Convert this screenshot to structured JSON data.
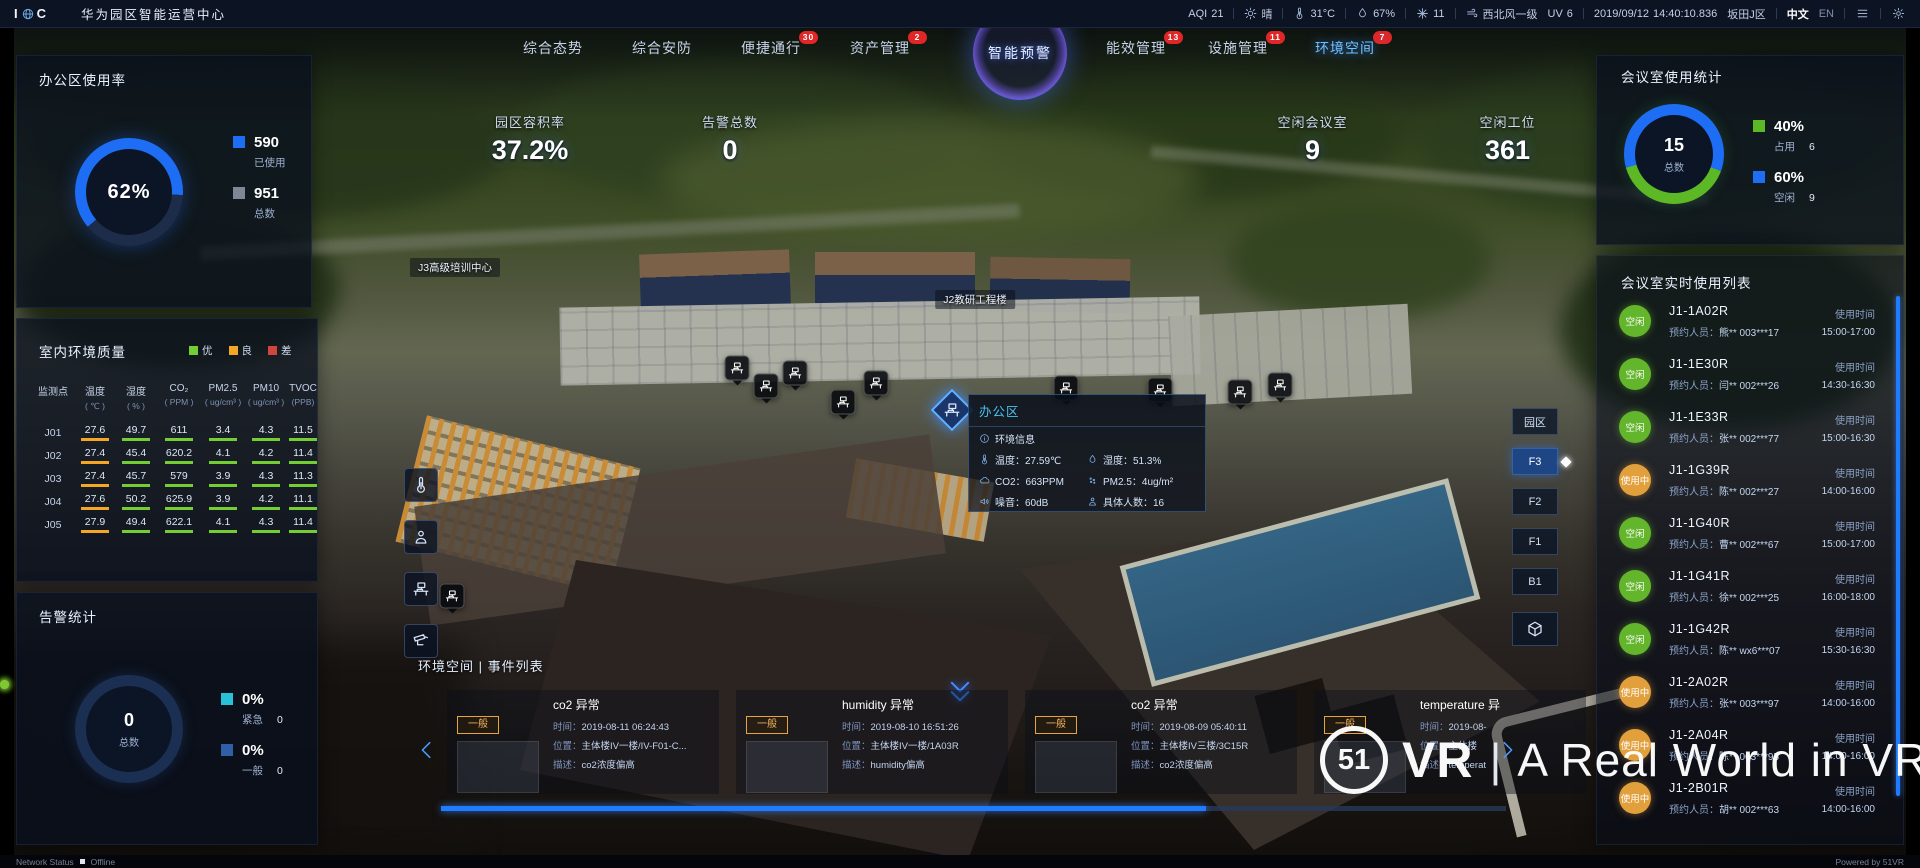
{
  "topbar": {
    "logo_left": "I",
    "logo_right": "C",
    "title": "华为园区智能运营中心",
    "aqi": {
      "label": "AQI",
      "value": "21"
    },
    "weather_text": "晴",
    "temperature": "31°C",
    "humidity": "67%",
    "pm_value": "11",
    "wind": "西北风一级",
    "uv": {
      "label": "UV",
      "value": "6"
    },
    "date": "2019/09/12",
    "time": "14:40:10.836",
    "district": "坂田J区",
    "lang": {
      "zh": "中文",
      "en": "EN"
    }
  },
  "nav": {
    "left_tabs": [
      {
        "label": "综合态势"
      },
      {
        "label": "综合安防"
      },
      {
        "label": "便捷通行",
        "badge": "30"
      },
      {
        "label": "资产管理",
        "badge": "2"
      }
    ],
    "right_tabs": [
      {
        "label": "能效管理",
        "badge": "13"
      },
      {
        "label": "设施管理",
        "badge": "11"
      },
      {
        "label": "环境空间",
        "badge": "7",
        "active": true
      }
    ],
    "center_label": "智能预警"
  },
  "kpis": {
    "left": [
      {
        "label": "园区容积率",
        "value": "37.2%"
      },
      {
        "label": "告警总数",
        "value": "0"
      }
    ],
    "right": [
      {
        "label": "空闲会议室",
        "value": "9"
      },
      {
        "label": "空闲工位",
        "value": "361"
      }
    ]
  },
  "office_usage": {
    "title": "办公区使用率",
    "percent": "62%",
    "legend": [
      {
        "value": "590",
        "label": "已使用",
        "color": "#1e6ef5"
      },
      {
        "value": "951",
        "label": "总数",
        "color": "#7d8798"
      }
    ]
  },
  "env_quality": {
    "title": "室内环境质量",
    "legend": [
      {
        "label": "优",
        "color": "#74ce33"
      },
      {
        "label": "良",
        "color": "#f5a623"
      },
      {
        "label": "差",
        "color": "#d0453e"
      }
    ],
    "columns": [
      [
        "监测点",
        ""
      ],
      [
        "温度",
        "( ℃ )"
      ],
      [
        "湿度",
        "( % )"
      ],
      [
        "CO₂",
        "( PPM )"
      ],
      [
        "PM2.5",
        "( ug/cm³ )"
      ],
      [
        "PM10",
        "( ug/cm³ )"
      ],
      [
        "TVOC",
        "(PPB)"
      ]
    ],
    "rows": [
      {
        "id": "J01",
        "values": [
          [
            "27.6",
            "o"
          ],
          [
            "49.7",
            "g"
          ],
          [
            "611",
            "g"
          ],
          [
            "3.4",
            "g"
          ],
          [
            "4.3",
            "g"
          ],
          [
            "11.5",
            "g"
          ]
        ]
      },
      {
        "id": "J02",
        "values": [
          [
            "27.4",
            "o"
          ],
          [
            "45.4",
            "g"
          ],
          [
            "620.2",
            "g"
          ],
          [
            "4.1",
            "g"
          ],
          [
            "4.2",
            "g"
          ],
          [
            "11.4",
            "g"
          ]
        ]
      },
      {
        "id": "J03",
        "values": [
          [
            "27.4",
            "o"
          ],
          [
            "45.7",
            "g"
          ],
          [
            "579",
            "g"
          ],
          [
            "3.9",
            "g"
          ],
          [
            "4.3",
            "g"
          ],
          [
            "11.3",
            "g"
          ]
        ]
      },
      {
        "id": "J04",
        "values": [
          [
            "27.6",
            "o"
          ],
          [
            "50.2",
            "g"
          ],
          [
            "625.9",
            "g"
          ],
          [
            "3.9",
            "g"
          ],
          [
            "4.2",
            "g"
          ],
          [
            "11.1",
            "g"
          ]
        ]
      },
      {
        "id": "J05",
        "values": [
          [
            "27.9",
            "o"
          ],
          [
            "49.4",
            "g"
          ],
          [
            "622.1",
            "g"
          ],
          [
            "4.1",
            "g"
          ],
          [
            "4.3",
            "g"
          ],
          [
            "11.4",
            "g"
          ]
        ]
      }
    ]
  },
  "alarm_stats": {
    "title": "告警统计",
    "total": "0",
    "total_label": "总数",
    "legend": [
      {
        "percent": "0%",
        "label": "紧急",
        "count": "0",
        "color": "#29c1d8"
      },
      {
        "percent": "0%",
        "label": "一般",
        "count": "0",
        "color": "#2e5fa8"
      }
    ]
  },
  "meeting_stats": {
    "title": "会议室使用统计",
    "total": "15",
    "total_label": "总数",
    "legend": [
      {
        "percent": "40%",
        "label": "占用",
        "count": "6",
        "color": "#5cb824"
      },
      {
        "percent": "60%",
        "label": "空闲",
        "count": "9",
        "color": "#1e6ef5"
      }
    ]
  },
  "meeting_list": {
    "title": "会议室实时使用列表",
    "person_label": "预约人员：",
    "time_label": "使用时间",
    "rows": [
      {
        "room": "J1-1A02R",
        "status": "空闲",
        "status_type": "free",
        "person": "熊** 003***17",
        "time": "15:00-17:00"
      },
      {
        "room": "J1-1E30R",
        "status": "空闲",
        "status_type": "free",
        "person": "闫** 002***26",
        "time": "14:30-16:30"
      },
      {
        "room": "J1-1E33R",
        "status": "空闲",
        "status_type": "free",
        "person": "张** 002***77",
        "time": "15:00-16:30"
      },
      {
        "room": "J1-1G39R",
        "status": "使用中",
        "status_type": "busy",
        "person": "陈** 002***27",
        "time": "14:00-16:00"
      },
      {
        "room": "J1-1G40R",
        "status": "空闲",
        "status_type": "free",
        "person": "曹** 002***67",
        "time": "15:00-17:00"
      },
      {
        "room": "J1-1G41R",
        "status": "空闲",
        "status_type": "free",
        "person": "徐** 002***25",
        "time": "16:00-18:00"
      },
      {
        "room": "J1-1G42R",
        "status": "空闲",
        "status_type": "free",
        "person": "陈** wx6***07",
        "time": "15:30-16:30"
      },
      {
        "room": "J1-2A02R",
        "status": "使用中",
        "status_type": "busy",
        "person": "张** 003***97",
        "time": "14:00-16:00"
      },
      {
        "room": "J1-2A04R",
        "status": "使用中",
        "status_type": "busy",
        "person": "陈** 003***95",
        "time": "14:00-16:00"
      },
      {
        "room": "J1-2B01R",
        "status": "使用中",
        "status_type": "busy",
        "person": "胡** 002***63",
        "time": "14:00-16:00"
      }
    ]
  },
  "events": {
    "title": "环境空间 | 事件列表",
    "time_label": "时间：",
    "loc_label": "位置：",
    "desc_label": "描述：",
    "cards": [
      {
        "level": "一般",
        "title": "co2 异常",
        "time": "2019-08-11 06:24:43",
        "loc": "主体楼IV一楼/IV-F01-C...",
        "desc": "co2浓度偏高"
      },
      {
        "level": "一般",
        "title": "humidity 异常",
        "time": "2019-08-10 16:51:26",
        "loc": "主体楼IV一楼/1A03R",
        "desc": "humidity偏高"
      },
      {
        "level": "一般",
        "title": "co2 异常",
        "time": "2019-08-09 05:40:11",
        "loc": "主体楼IV三楼/3C15R",
        "desc": "co2浓度偏高"
      },
      {
        "level": "一般",
        "title": "temperature 异",
        "time": "2019-08-",
        "loc": "主体楼",
        "desc": "temperat"
      }
    ]
  },
  "tooltip": {
    "title": "办公区",
    "rows": [
      {
        "ia": "info",
        "a": "环境信息",
        "ib": "",
        "b": ""
      },
      {
        "ia": "thermometer",
        "a": "温度：27.59℃",
        "ib": "drop",
        "b": "湿度：51.3%"
      },
      {
        "ia": "co2",
        "a": "CO2：663PPM",
        "ib": "pm",
        "b": "PM2.5：4ug/m²"
      },
      {
        "ia": "noise",
        "a": "噪音：60dB",
        "ib": "meeting-person",
        "b": "具体人数：16"
      }
    ]
  },
  "floors": {
    "items": [
      "园区",
      "F3",
      "F2",
      "F1",
      "B1"
    ],
    "active": "F3"
  },
  "toolbar": {
    "buttons": [
      "thermometer",
      "meeting-person",
      "workstation",
      "camera"
    ]
  },
  "scene": {
    "labels": [
      {
        "text": "J3高级培训中心",
        "x": 455,
        "y": 258
      },
      {
        "text": "J2教研工程楼",
        "x": 975,
        "y": 290
      }
    ],
    "markers": [
      [
        737,
        368
      ],
      [
        766,
        386
      ],
      [
        795,
        373
      ],
      [
        843,
        402
      ],
      [
        876,
        383
      ],
      [
        1066,
        388
      ],
      [
        1160,
        390
      ],
      [
        1240,
        392
      ],
      [
        1280,
        385
      ],
      [
        452,
        596
      ]
    ]
  },
  "watermark": {
    "logo_text": "51",
    "brand": "VR",
    "divider": "|",
    "tagline": "A Real World in VR"
  },
  "footer": {
    "network_label": "Network Status",
    "network_value": "Offline",
    "powered_by": "Powered by 51VR"
  }
}
